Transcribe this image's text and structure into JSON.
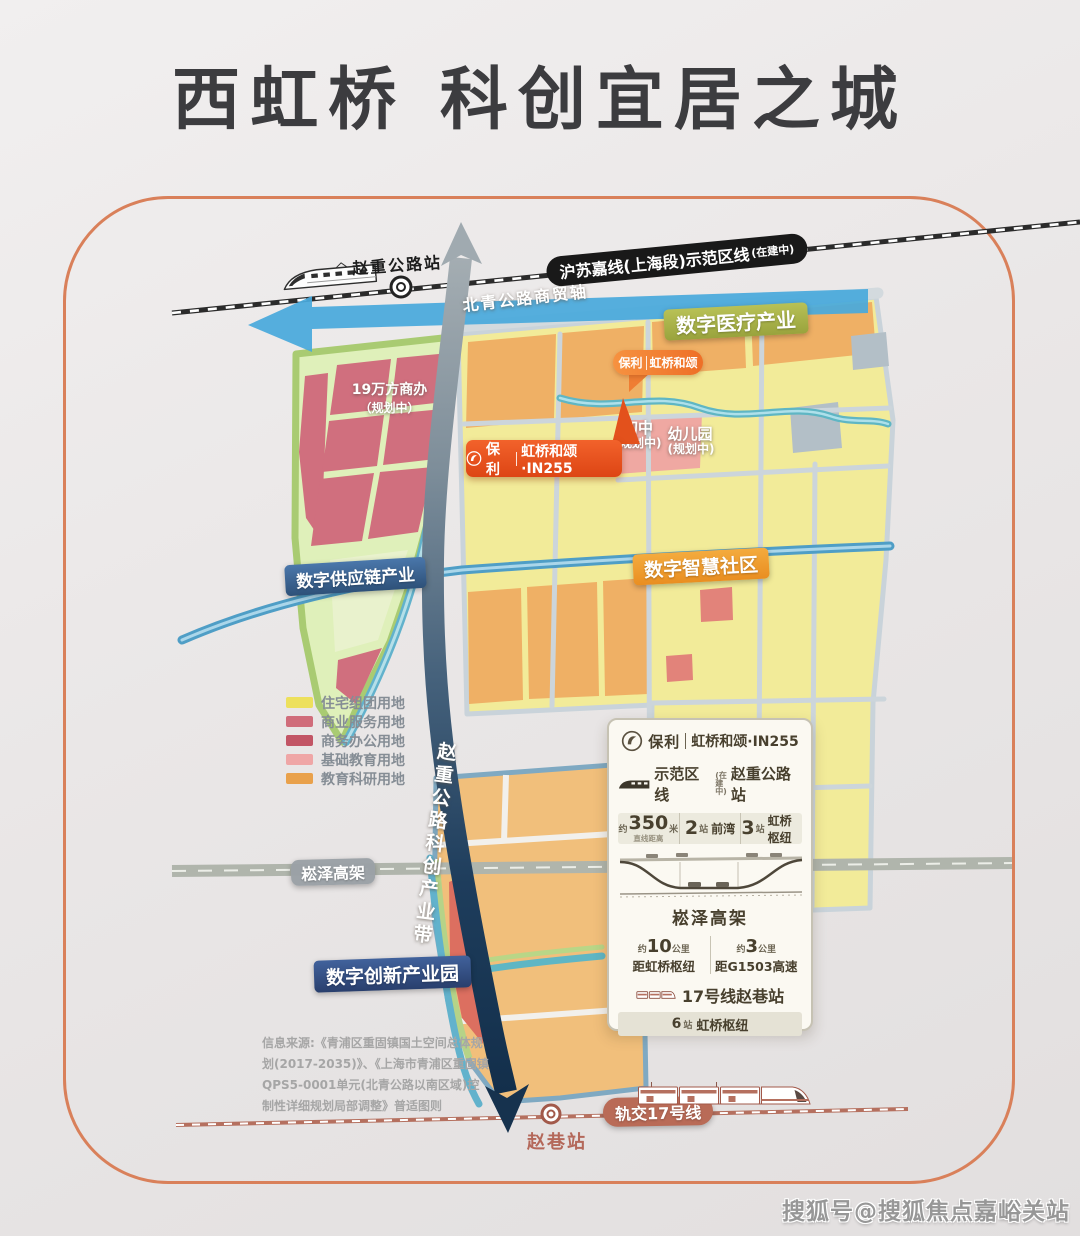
{
  "page": {
    "title": "西虹桥 科创宜居之城",
    "watermark": "搜狐号@搜狐焦点嘉峪关站"
  },
  "map": {
    "top_rail": {
      "label": "沪苏嘉线(上海段)示范区线",
      "label_small": "(在建中)",
      "station": "赵重公路站"
    },
    "trade_axis": "北青公路商贸轴",
    "zone_medical": "数字医疗产业",
    "zone_supply": "数字供应链产业",
    "zone_community": "数字智慧社区",
    "zone_innovation": "数字创新产业园",
    "belt": "赵重公路科创产业带",
    "elevated": "崧泽高架",
    "office": "19万方商办",
    "office_sub": "（规划中）",
    "school": "初中",
    "school_sub": "(规划中)",
    "kindergarten": "幼儿园",
    "kindergarten_sub": "(规划中)",
    "bubble_small_brand": "保利",
    "bubble_small_name": "虹桥和颂",
    "bubble_large_brand": "保利",
    "bubble_large_name": "虹桥和颂·IN255",
    "bottom_rail": {
      "label": "轨交17号线",
      "station": "赵巷站"
    }
  },
  "legend": {
    "items": [
      {
        "label": "住宅组团用地",
        "color": "#ede05c"
      },
      {
        "label": "商业服务用地",
        "color": "#d06c7a"
      },
      {
        "label": "商务办公用地",
        "color": "#c25565"
      },
      {
        "label": "基础教育用地",
        "color": "#efa6a6"
      },
      {
        "label": "教育科研用地",
        "color": "#e9a14b"
      }
    ]
  },
  "card": {
    "brand": "保利",
    "project": "虹桥和颂·IN255",
    "rail_prefix": "示范区线",
    "rail_status": "(在建中)",
    "rail_station": "赵重公路站",
    "stat1_pre": "约",
    "stat1_num": "350",
    "stat1_unit": "米",
    "stat1_sub": "直线距离",
    "stat2_num": "2",
    "stat2_unit": "站",
    "stat2_dest": "前湾",
    "stat3_num": "3",
    "stat3_unit": "站",
    "stat3_dest": "虹桥枢纽",
    "road": "崧泽高架",
    "dist1_pre": "约",
    "dist1_num": "10",
    "dist1_unit": "公里",
    "dist1_dest_pre": "距",
    "dist1_dest": "虹桥枢纽",
    "dist2_pre": "约",
    "dist2_num": "3",
    "dist2_unit": "公里",
    "dist2_dest_pre": "距",
    "dist2_dest": "G1503高速",
    "metro_line": "17号线赵巷站",
    "metro_num": "6",
    "metro_unit": "站",
    "metro_dest": "虹桥枢纽"
  },
  "source": {
    "l1": "信息来源:《青浦区重固镇国土空间总体规",
    "l2": "划(2017-2035)》、《上海市青浦区重固镇",
    "l3": "QPS5-0001单元(北青公路以南区域)控",
    "l4": "制性详细规划局部调整》普适图则"
  },
  "colors": {
    "frame_orange": "#d9805a",
    "brand_orange": "#e3511c",
    "axis_blue": "#49a9dc",
    "belt_navy": "#16324e",
    "metro17_brown": "#b96b57"
  }
}
